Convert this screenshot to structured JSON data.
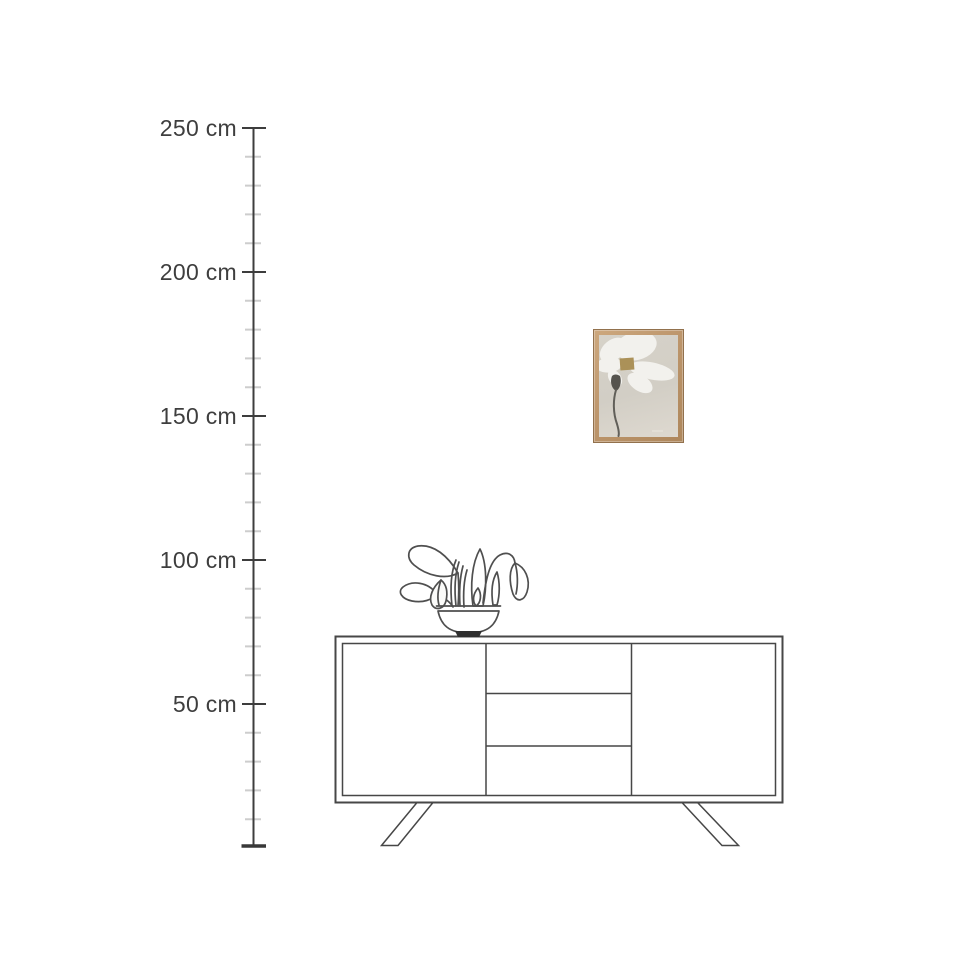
{
  "scene": {
    "background_color": "#ffffff",
    "drawing_line_color": "#474747"
  },
  "ruler": {
    "labels": [
      "250 cm",
      "200 cm",
      "150 cm",
      "100 cm",
      "50 cm"
    ],
    "unit": "cm",
    "max_cm": 250,
    "major_step_cm": 50,
    "minor_step_cm": 10,
    "line_color": "#3d3d3d",
    "minor_tick_color": "#cdcdcd",
    "label_color": "#3e3e3e"
  },
  "product": {
    "kind": "framed flower art print",
    "frame_color": "#bb9269",
    "frame_edge_color": "#92714d",
    "canvas_color": "#d6d2c9",
    "petal_color": "#f2f1ed",
    "flower_center_color": "#ab9158",
    "stem_color": "#615f59"
  },
  "furniture": {
    "sideboard": {
      "kind": "sideboard line drawing"
    },
    "plant": {
      "kind": "potted plant line drawing"
    }
  }
}
